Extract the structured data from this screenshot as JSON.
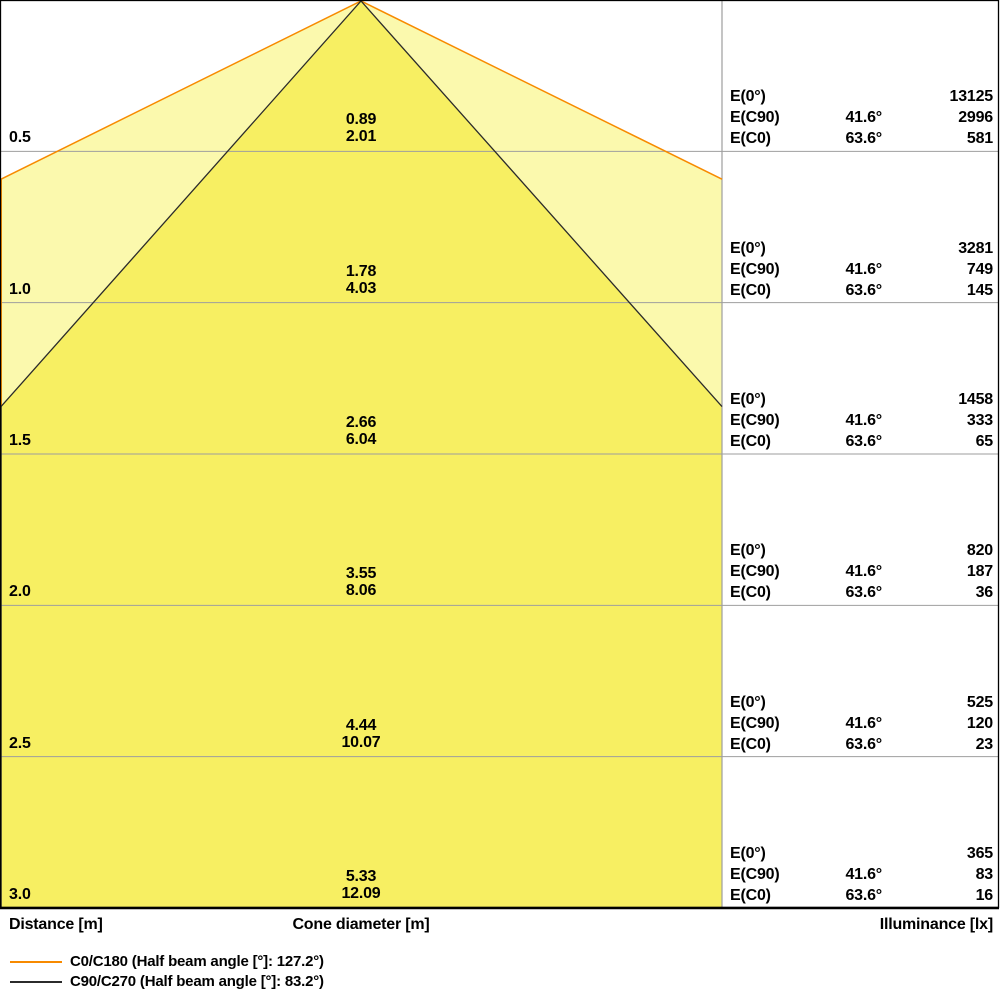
{
  "chart_data": {
    "type": "area",
    "title": "Luminous cone diagram (beam spread vs distance with illuminance table)",
    "axis_labels": {
      "left": "Distance [m]",
      "center": "Cone diameter [m]",
      "right": "Illuminance [lx]"
    },
    "row_line_labels": {
      "e0": "E(0°)",
      "ec90": "E(C90)",
      "ec0": "E(C0)"
    },
    "angles": {
      "ec90": "41.6°",
      "ec0": "63.6°"
    },
    "distances_m": [
      0.5,
      1.0,
      1.5,
      2.0,
      2.5,
      3.0
    ],
    "rows": [
      {
        "distance": "0.5",
        "cone_c90": "0.89",
        "cone_c0": "2.01",
        "e0": "13125",
        "ec90": "2996",
        "ec0": "581"
      },
      {
        "distance": "1.0",
        "cone_c90": "1.78",
        "cone_c0": "4.03",
        "e0": "3281",
        "ec90": "749",
        "ec0": "145"
      },
      {
        "distance": "1.5",
        "cone_c90": "2.66",
        "cone_c0": "6.04",
        "e0": "1458",
        "ec90": "333",
        "ec0": "65"
      },
      {
        "distance": "2.0",
        "cone_c90": "3.55",
        "cone_c0": "8.06",
        "e0": "820",
        "ec90": "187",
        "ec0": "36"
      },
      {
        "distance": "2.5",
        "cone_c90": "4.44",
        "cone_c0": "10.07",
        "e0": "525",
        "ec90": "120",
        "ec0": "23"
      },
      {
        "distance": "3.0",
        "cone_c90": "5.33",
        "cone_c0": "12.09",
        "e0": "365",
        "ec90": "83",
        "ec0": "16"
      }
    ],
    "cones": [
      {
        "name": "C0/C180",
        "half_beam_angle_deg": 127.2,
        "half_angle_deg": 63.6,
        "line_color": "#f78a00",
        "fill_color": "#fbf9ad"
      },
      {
        "name": "C90/C270",
        "half_beam_angle_deg": 83.2,
        "half_angle_deg": 41.6,
        "line_color": "#2b2b2b",
        "fill_color": "#f7ef62"
      }
    ],
    "legend": [
      {
        "label": "C0/C180 (Half beam angle [°]: 127.2°)",
        "color": "#f78a00"
      },
      {
        "label": "C90/C270 (Half beam angle [°]: 83.2°)",
        "color": "#2b2b2b"
      }
    ],
    "colors": {
      "grid": "#9e9e9e",
      "border": "#000000",
      "background": "#ffffff",
      "text": "#000000"
    },
    "layout_hints": {
      "grid": "on",
      "legend_position": "bottom-left",
      "table_position": "right"
    }
  }
}
